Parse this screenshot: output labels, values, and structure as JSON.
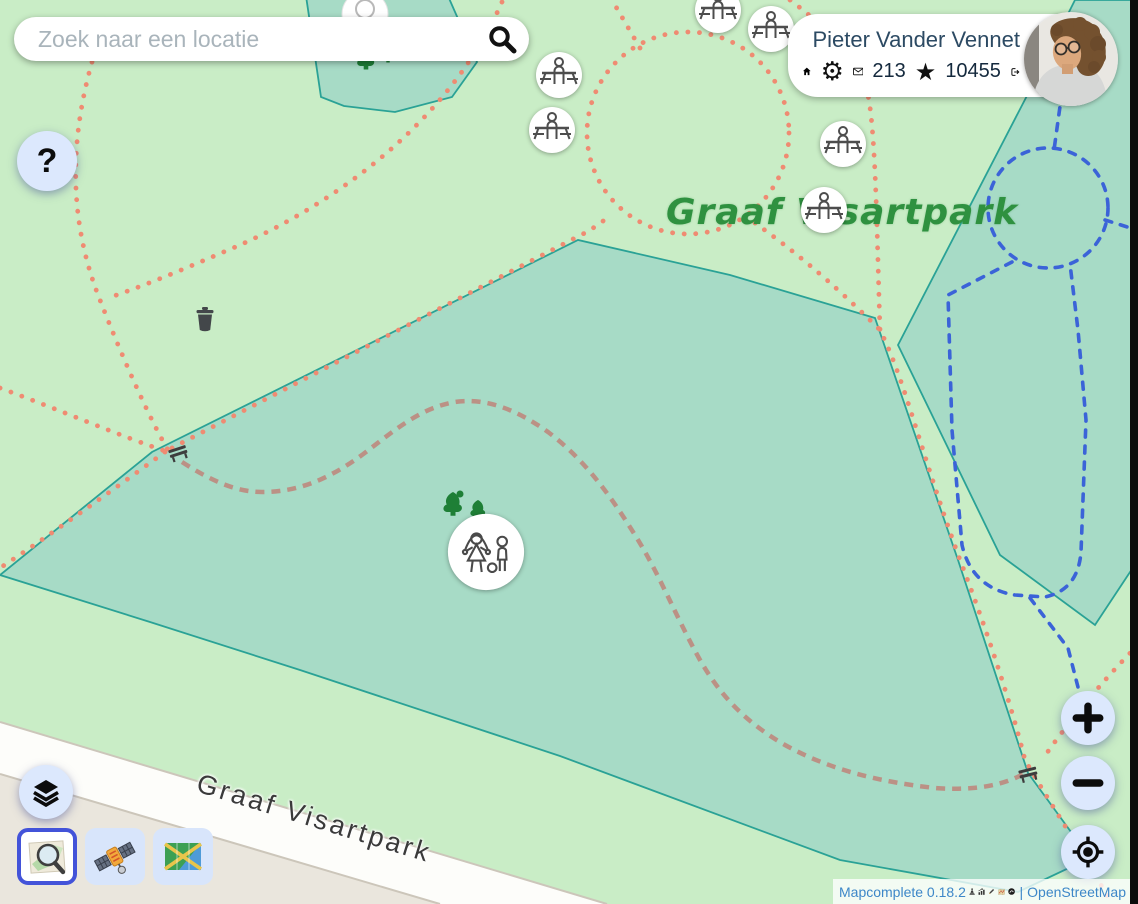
{
  "search": {
    "placeholder": "Zoek naar een locatie"
  },
  "help_button": {
    "label": "?"
  },
  "user_panel": {
    "name": "Pieter Vander Vennet",
    "messages_count": "213",
    "stars_count": "10455"
  },
  "map_labels": {
    "park_name": "Graaf Visartpark",
    "street_name": "Graaf Visartpark"
  },
  "attribution": {
    "app_version": "Mapcomplete 0.18.2",
    "divider": "|",
    "osm_label": "OpenStreetMap"
  },
  "icons": {
    "gear_glyph": "⚙",
    "star_glyph": "★",
    "zoom_in_glyph": "+",
    "zoom_out_glyph": "−"
  },
  "colors": {
    "selected_basemap_border": "#4353d9",
    "control_background": "#dce8fd",
    "link_blue": "#3d87c8",
    "park_label_green": "#2f9140",
    "map_light_green": "#c9edc6",
    "map_forest_teal": "#a7dbc6",
    "path_red": "#ef8b72",
    "path_blue": "#3b63d8"
  }
}
